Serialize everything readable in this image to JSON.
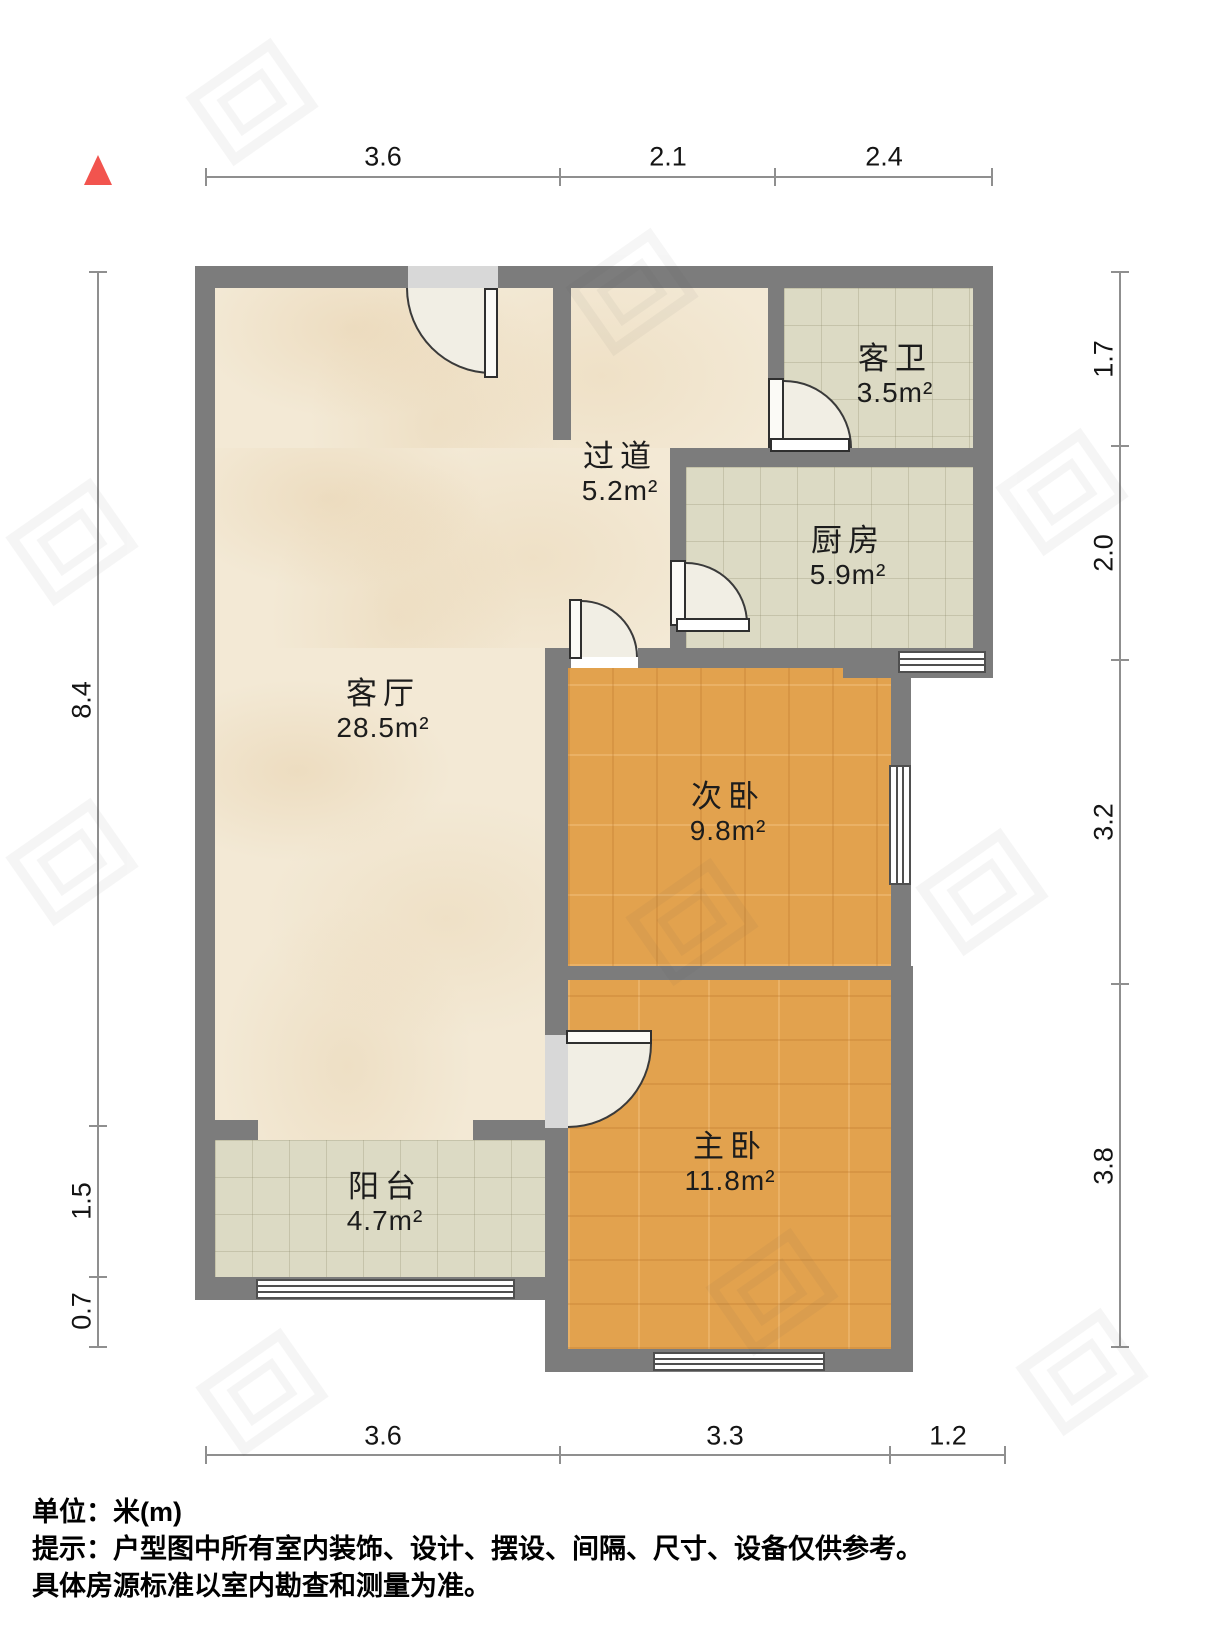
{
  "rooms": [
    {
      "name": "客厅",
      "area": "28.5m²"
    },
    {
      "name": "过道",
      "area": "5.2m²"
    },
    {
      "name": "客卫",
      "area": "3.5m²"
    },
    {
      "name": "厨房",
      "area": "5.9m²"
    },
    {
      "name": "次卧",
      "area": "9.8m²"
    },
    {
      "name": "主卧",
      "area": "11.8m²"
    },
    {
      "name": "阳台",
      "area": "4.7m²"
    }
  ],
  "dimensions": {
    "top": [
      "3.6",
      "2.1",
      "2.4"
    ],
    "bottom": [
      "3.6",
      "3.3",
      "1.2"
    ],
    "left": [
      "8.4",
      "1.5",
      "0.7"
    ],
    "right": [
      "1.7",
      "2.0",
      "3.2",
      "3.8"
    ]
  },
  "footer": {
    "unit": "单位：米(m)",
    "note1": "提示：户型图中所有室内装饰、设计、摆设、间隔、尺寸、设备仅供参考。",
    "note2": "具体房源标准以室内勘查和测量为准。"
  },
  "colors": {
    "wall": "#7c7c7c",
    "wood_floor": "#e2a24e",
    "tile_floor": "#dcdac4",
    "marble_floor": "#f3e9d5",
    "north_arrow": "#f2544e",
    "dimension_line": "#8f8f8f"
  }
}
